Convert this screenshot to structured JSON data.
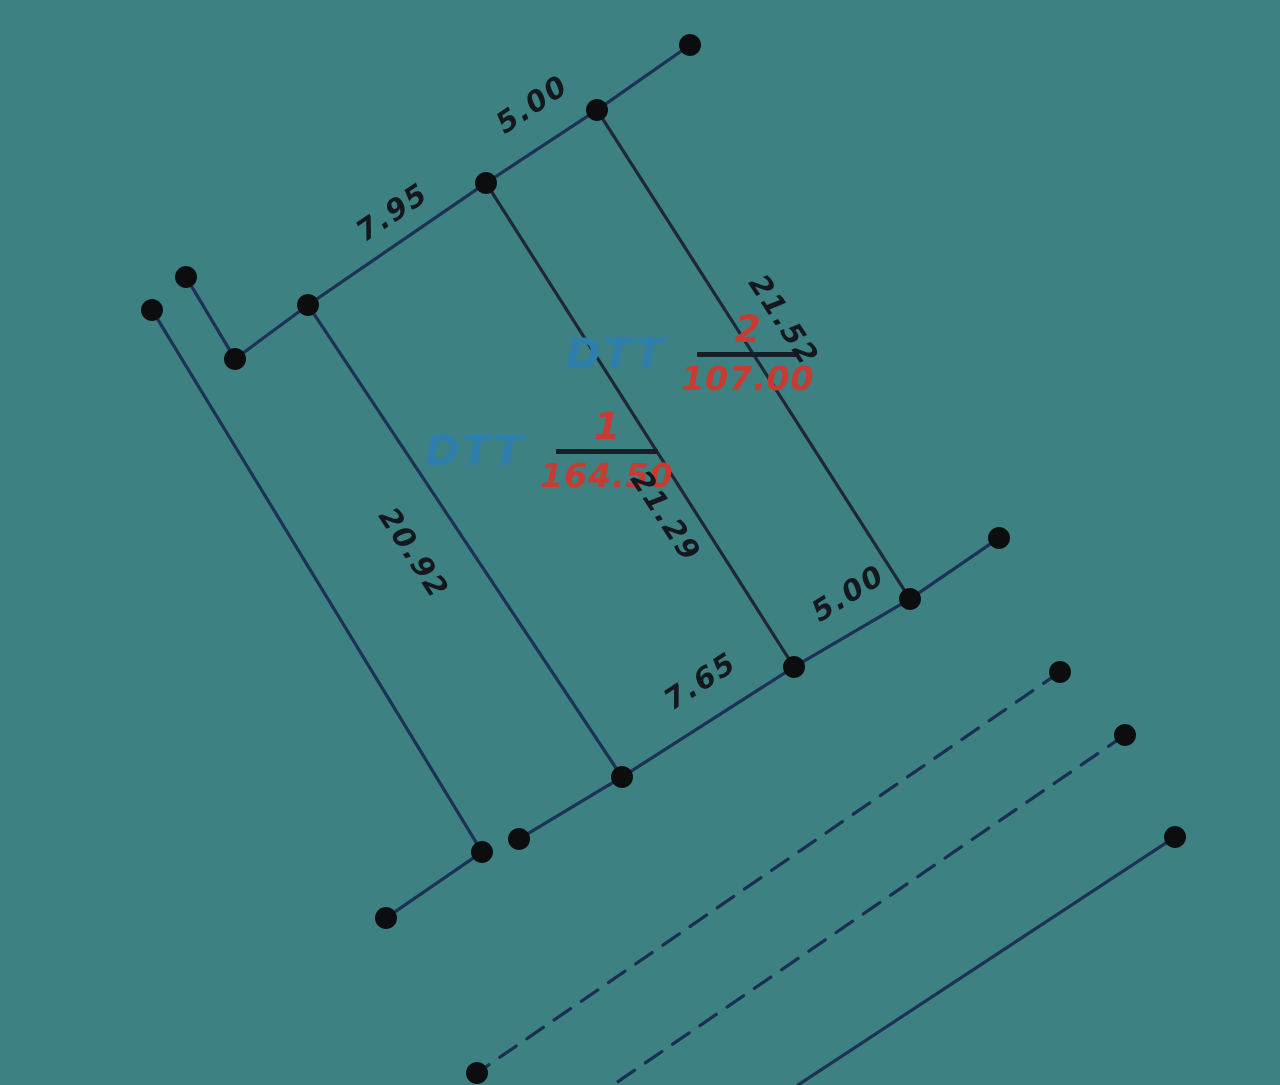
{
  "canvas": {
    "width": 1280,
    "height": 1085,
    "background_color": "#3d8182"
  },
  "colors": {
    "boundary_line": "#1d3056",
    "parcel_edge": "#1f2734",
    "dashed_line": "#1b2d52",
    "vertex_dot": "#0c0d0e",
    "dimension_text": "#14181d",
    "area_text": "#c93a30",
    "dtt_text": "#2e7fad",
    "fraction_bar": "#191e26"
  },
  "style": {
    "line_width": 3.2,
    "dash_pattern": "20 13",
    "dot_radius": 11
  },
  "parcels": [
    {
      "name": "DTT",
      "number": "1",
      "area": "164.50",
      "x": 425,
      "y": 450,
      "bar_width": 102
    },
    {
      "name": "DTT",
      "number": "2",
      "area": "107.00",
      "x": 566,
      "y": 353,
      "bar_width": 102
    }
  ],
  "dimensions": [
    {
      "text": "5.00",
      "x": 532,
      "y": 104,
      "angle": -34
    },
    {
      "text": "7.95",
      "x": 392,
      "y": 212,
      "angle": -34
    },
    {
      "text": "21.52",
      "x": 784,
      "y": 320,
      "angle": 57
    },
    {
      "text": "21.29",
      "x": 666,
      "y": 516,
      "angle": 57
    },
    {
      "text": "20.92",
      "x": 414,
      "y": 553,
      "angle": 57
    },
    {
      "text": "5.00",
      "x": 848,
      "y": 593,
      "angle": -32
    },
    {
      "text": "7.65",
      "x": 700,
      "y": 681,
      "angle": -33
    }
  ],
  "polylines": [
    {
      "name": "boundary-top",
      "color": "boundary_line",
      "dashed": false,
      "points": [
        [
          690,
          45
        ],
        [
          597,
          110
        ],
        [
          486,
          183
        ],
        [
          308,
          305
        ],
        [
          235,
          359
        ],
        [
          186,
          277
        ]
      ]
    },
    {
      "name": "boundary-left",
      "color": "boundary_line",
      "dashed": false,
      "points": [
        [
          152,
          310
        ],
        [
          482,
          852
        ],
        [
          386,
          918
        ]
      ]
    },
    {
      "name": "boundary-bottom",
      "color": "boundary_line",
      "dashed": false,
      "points": [
        [
          999,
          538
        ],
        [
          910,
          599
        ],
        [
          794,
          667
        ],
        [
          622,
          777
        ],
        [
          519,
          839
        ]
      ]
    },
    {
      "name": "parcel2-right-edge",
      "color": "parcel_edge",
      "dashed": false,
      "points": [
        [
          597,
          110
        ],
        [
          910,
          599
        ]
      ]
    },
    {
      "name": "parcel-shared-edge",
      "color": "parcel_edge",
      "dashed": false,
      "points": [
        [
          486,
          183
        ],
        [
          794,
          667
        ]
      ]
    },
    {
      "name": "parcel1-left-edge",
      "color": "boundary_line",
      "dashed": false,
      "points": [
        [
          308,
          305
        ],
        [
          622,
          777
        ]
      ]
    },
    {
      "name": "road-edge-solid",
      "color": "boundary_line",
      "dashed": false,
      "points": [
        [
          1175,
          837
        ],
        [
          798,
          1085
        ]
      ]
    },
    {
      "name": "road-edge-dashed-1",
      "color": "dashed_line",
      "dashed": true,
      "points": [
        [
          1060,
          672
        ],
        [
          477,
          1073
        ]
      ]
    },
    {
      "name": "road-edge-dashed-2",
      "color": "dashed_line",
      "dashed": true,
      "points": [
        [
          1125,
          735
        ],
        [
          613,
          1085
        ]
      ]
    }
  ],
  "dots": [
    [
      690,
      45
    ],
    [
      597,
      110
    ],
    [
      486,
      183
    ],
    [
      308,
      305
    ],
    [
      235,
      359
    ],
    [
      186,
      277
    ],
    [
      152,
      310
    ],
    [
      482,
      852
    ],
    [
      386,
      918
    ],
    [
      999,
      538
    ],
    [
      910,
      599
    ],
    [
      794,
      667
    ],
    [
      622,
      777
    ],
    [
      519,
      839
    ],
    [
      1060,
      672
    ],
    [
      477,
      1073
    ],
    [
      1125,
      735
    ],
    [
      1175,
      837
    ]
  ]
}
